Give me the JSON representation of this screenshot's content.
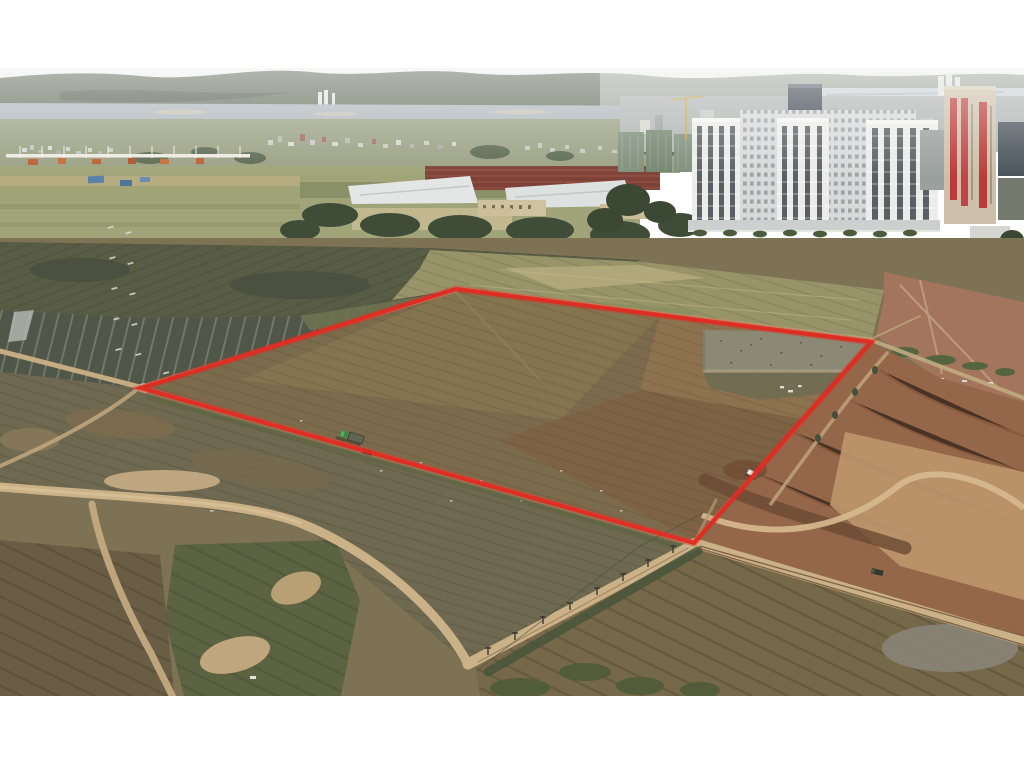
{
  "meta": {
    "type": "aerial-drone-photograph",
    "subject": "Drone photo of a cleared land parcel outlined in red, surrounded by strip farmland, dirt roads and earthworks, with factories and a high-rise residential complex on the horizon",
    "canvas": {
      "width": 1024,
      "height": 768
    },
    "photo_frame": {
      "left": 0,
      "top": 68,
      "width": 1024,
      "height": 628
    }
  },
  "boundary": {
    "label": "red-parcel-outline",
    "points": "456,289 871,342 694,543 141,388",
    "vertices": [
      {
        "x": 456,
        "y": 289
      },
      {
        "x": 871,
        "y": 342
      },
      {
        "x": 694,
        "y": 543
      },
      {
        "x": 141,
        "y": 388
      }
    ],
    "color": "#e02b22",
    "stroke_width": 4.2
  },
  "palette": {
    "frame_white": "#ffffff",
    "sky_top": "#f0f1ef",
    "sky_bottom": "#ced3d2",
    "hills": "#66715f",
    "river": "#adb6ba",
    "water_right": "#c9d1d4",
    "sandbar": "#c9c3b4",
    "town_base": "#9aa083",
    "town_building_light": "#d8d9d1",
    "town_building_grey": "#aeb0a8",
    "town_roof_red": "#9d6a5e",
    "tree_dark": "#47543c",
    "field_light": "#a0a478",
    "field_tan": "#b3ab7e",
    "scrub": "#585c45",
    "strip_field": "#515748",
    "strip_pale": "#d9dcd4",
    "hoarding_white": "#eceae2",
    "hoarding_orange": "#bf5a31",
    "factory_roof_white": "#e3e6e4",
    "factory_roof_red": "#7c4237",
    "factory_wall_beige": "#cfc29e",
    "net_building_green": "#7a8b76",
    "crane_yellow": "#c9a636",
    "slab_white": "#d8dad9",
    "tower_white": "#ebecea",
    "tower_window": "#595f63",
    "banner_tower_beige": "#cdc0aa",
    "banner_red": "#bb3b38",
    "office_dark": "#3e4850",
    "construction_tan": "#c2a98a",
    "blue_roof": "#4678ac",
    "dirt_road": "#cbb187",
    "pasture": "#6e6950",
    "parcel_soil": "#7b6b4c",
    "parcel_soil_red": "#8f7350",
    "pond": "#8b8973",
    "marsh": "#6f6b52",
    "excavated_red": "#95674a",
    "plateau_tan": "#bb9569",
    "gully_brown": "#6b4a33",
    "field_bottom": "#76694a",
    "scrub_bottom": "#5b6342",
    "rubble_grey": "#8b867a",
    "truck_green": "#3f8a49",
    "trailer_grey": "#606452",
    "vehicle_dark": "#35372f",
    "car_white": "#eef0ea",
    "pole": "#3a3a33"
  },
  "landmarks": {
    "sky": "hazy overcast sky",
    "hills": "forested ridge on the horizon",
    "river": "river with sandbars behind distant village",
    "village": "low-rise village and town along the river",
    "factory": "warehouses with white and oxide-red roofs among trees",
    "towers": "white residential high-rise cluster",
    "banner_tower": "beige tower with red vertical banners",
    "construction": "construction yard with sheds and blue roofs",
    "farmland": "dark strip fields and scrub pasture",
    "parcel": "plowed brown soil inside the red outline",
    "pond": "muddy pond in the north-east corner of the parcel",
    "excavation": "red-brown graded earthworks east of the parcel",
    "roads": "dirt roads and tracks with utility poles"
  },
  "vehicles": [
    {
      "name": "green-dump-truck",
      "x": 347,
      "y": 431,
      "rotation": 17
    },
    {
      "name": "dark-trailer",
      "x": 363,
      "y": 448,
      "rotation": 17
    },
    {
      "name": "white-pickup",
      "x": 749,
      "y": 469,
      "rotation": 28
    },
    {
      "name": "dark-truck",
      "x": 872,
      "y": 568,
      "rotation": 13
    }
  ]
}
